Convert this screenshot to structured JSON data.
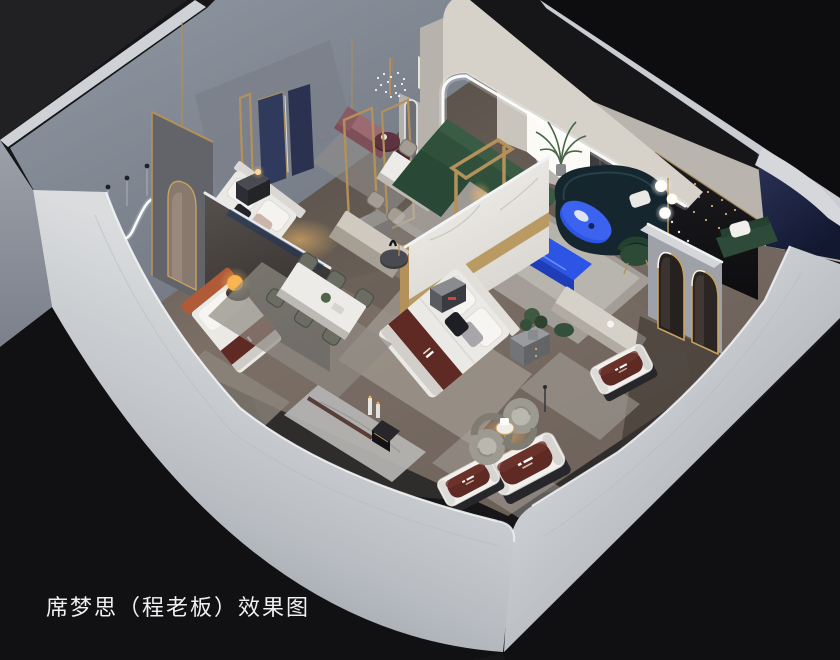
{
  "caption": {
    "text": "席梦思（程老板）效果图"
  },
  "palette": {
    "bg": "#161618",
    "bg_top": "#212124",
    "bg_right": "#0d0d0f",
    "ground": "#111113",
    "wall_bright": "#d7d9dc",
    "wall_mid": "#aeb2b7",
    "wall_deep": "#8d939b",
    "wall_blue": "#858c98",
    "floor": "#6e6259",
    "floor_dark": "#4e463f",
    "rug": "#9b968e",
    "rug_light": "#bdbab4",
    "cream": "#d6d2ca",
    "marble": "#f3f1ed",
    "navy": "#1d2444",
    "navy_panel": "#303a5c",
    "maroon": "#5e2a23",
    "green": "#32523c",
    "teal": "#16262e",
    "blue": "#2c55e6",
    "blue_deep": "#1e3db8",
    "gold": "#b4905a",
    "mauve": "#9c6b72",
    "burgundy": "#4e2631",
    "rust": "#b05a38",
    "lamp": "#f6ac3f",
    "black_wall": "#131316",
    "bed_white": "#ebe9e5",
    "led": "#ffffff",
    "text": "#f0f0f0"
  }
}
